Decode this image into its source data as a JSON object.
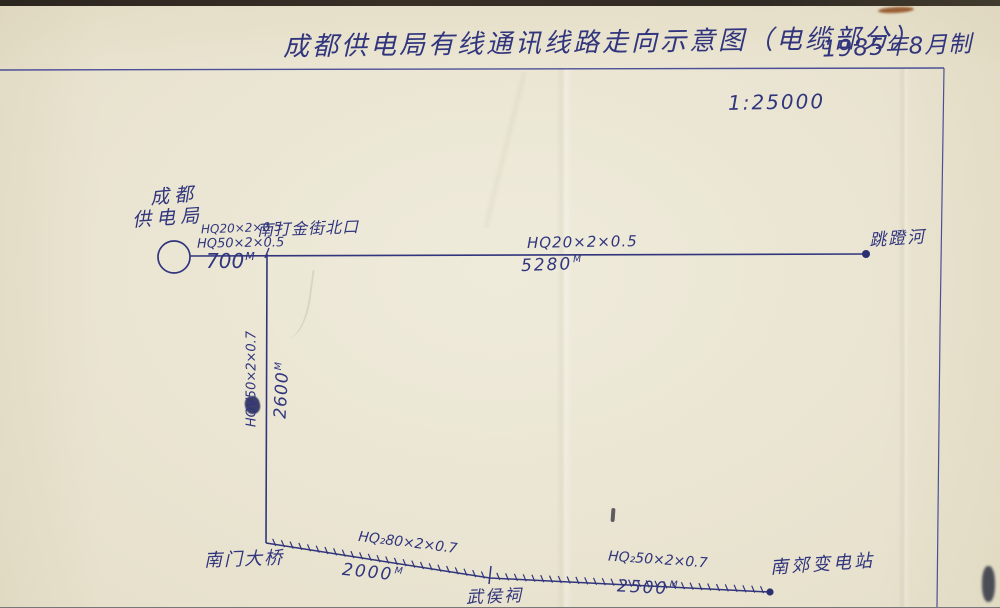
{
  "header": {
    "title": "成都供电局有线通讯线路走向示意图（电缆部分）",
    "edition": "1985年8月制",
    "scale_label": "1:25000"
  },
  "colors": {
    "ink": "#31357d",
    "paper": "#eae5d2",
    "frame_line": "#4c4f97"
  },
  "diagram": {
    "nodes": {
      "bureau": {
        "line1": "成都",
        "line2": "供电局",
        "shape": "circle"
      },
      "dajinjie": {
        "label": "南打金街北口"
      },
      "tiaodenghe": {
        "label": "跳蹬河"
      },
      "nanmen": {
        "label": "南门大桥"
      },
      "wuhouci": {
        "label": "武侯祠"
      },
      "nanjiao": {
        "label": "南郊变电站"
      }
    },
    "segments": {
      "bureau_to_dajinjie": {
        "cable1": "HQ20×2×0.5",
        "cable2": "HQ50×2×0.5",
        "distance": "700",
        "unit": "M"
      },
      "dajinjie_to_tiaodenghe": {
        "cable": "HQ20×2×0.5",
        "distance": "5280",
        "unit": "M"
      },
      "dajinjie_to_nanmen": {
        "cable": "HQV50×2×0.7",
        "distance": "2600",
        "unit": "M"
      },
      "nanmen_to_wuhouci": {
        "cable": "HQ₂80×2×0.7",
        "distance": "2000",
        "unit": "M"
      },
      "wuhouci_to_nanjiao": {
        "cable": "HQ₂50×2×0.7",
        "distance": "2500",
        "unit": "M"
      }
    }
  }
}
